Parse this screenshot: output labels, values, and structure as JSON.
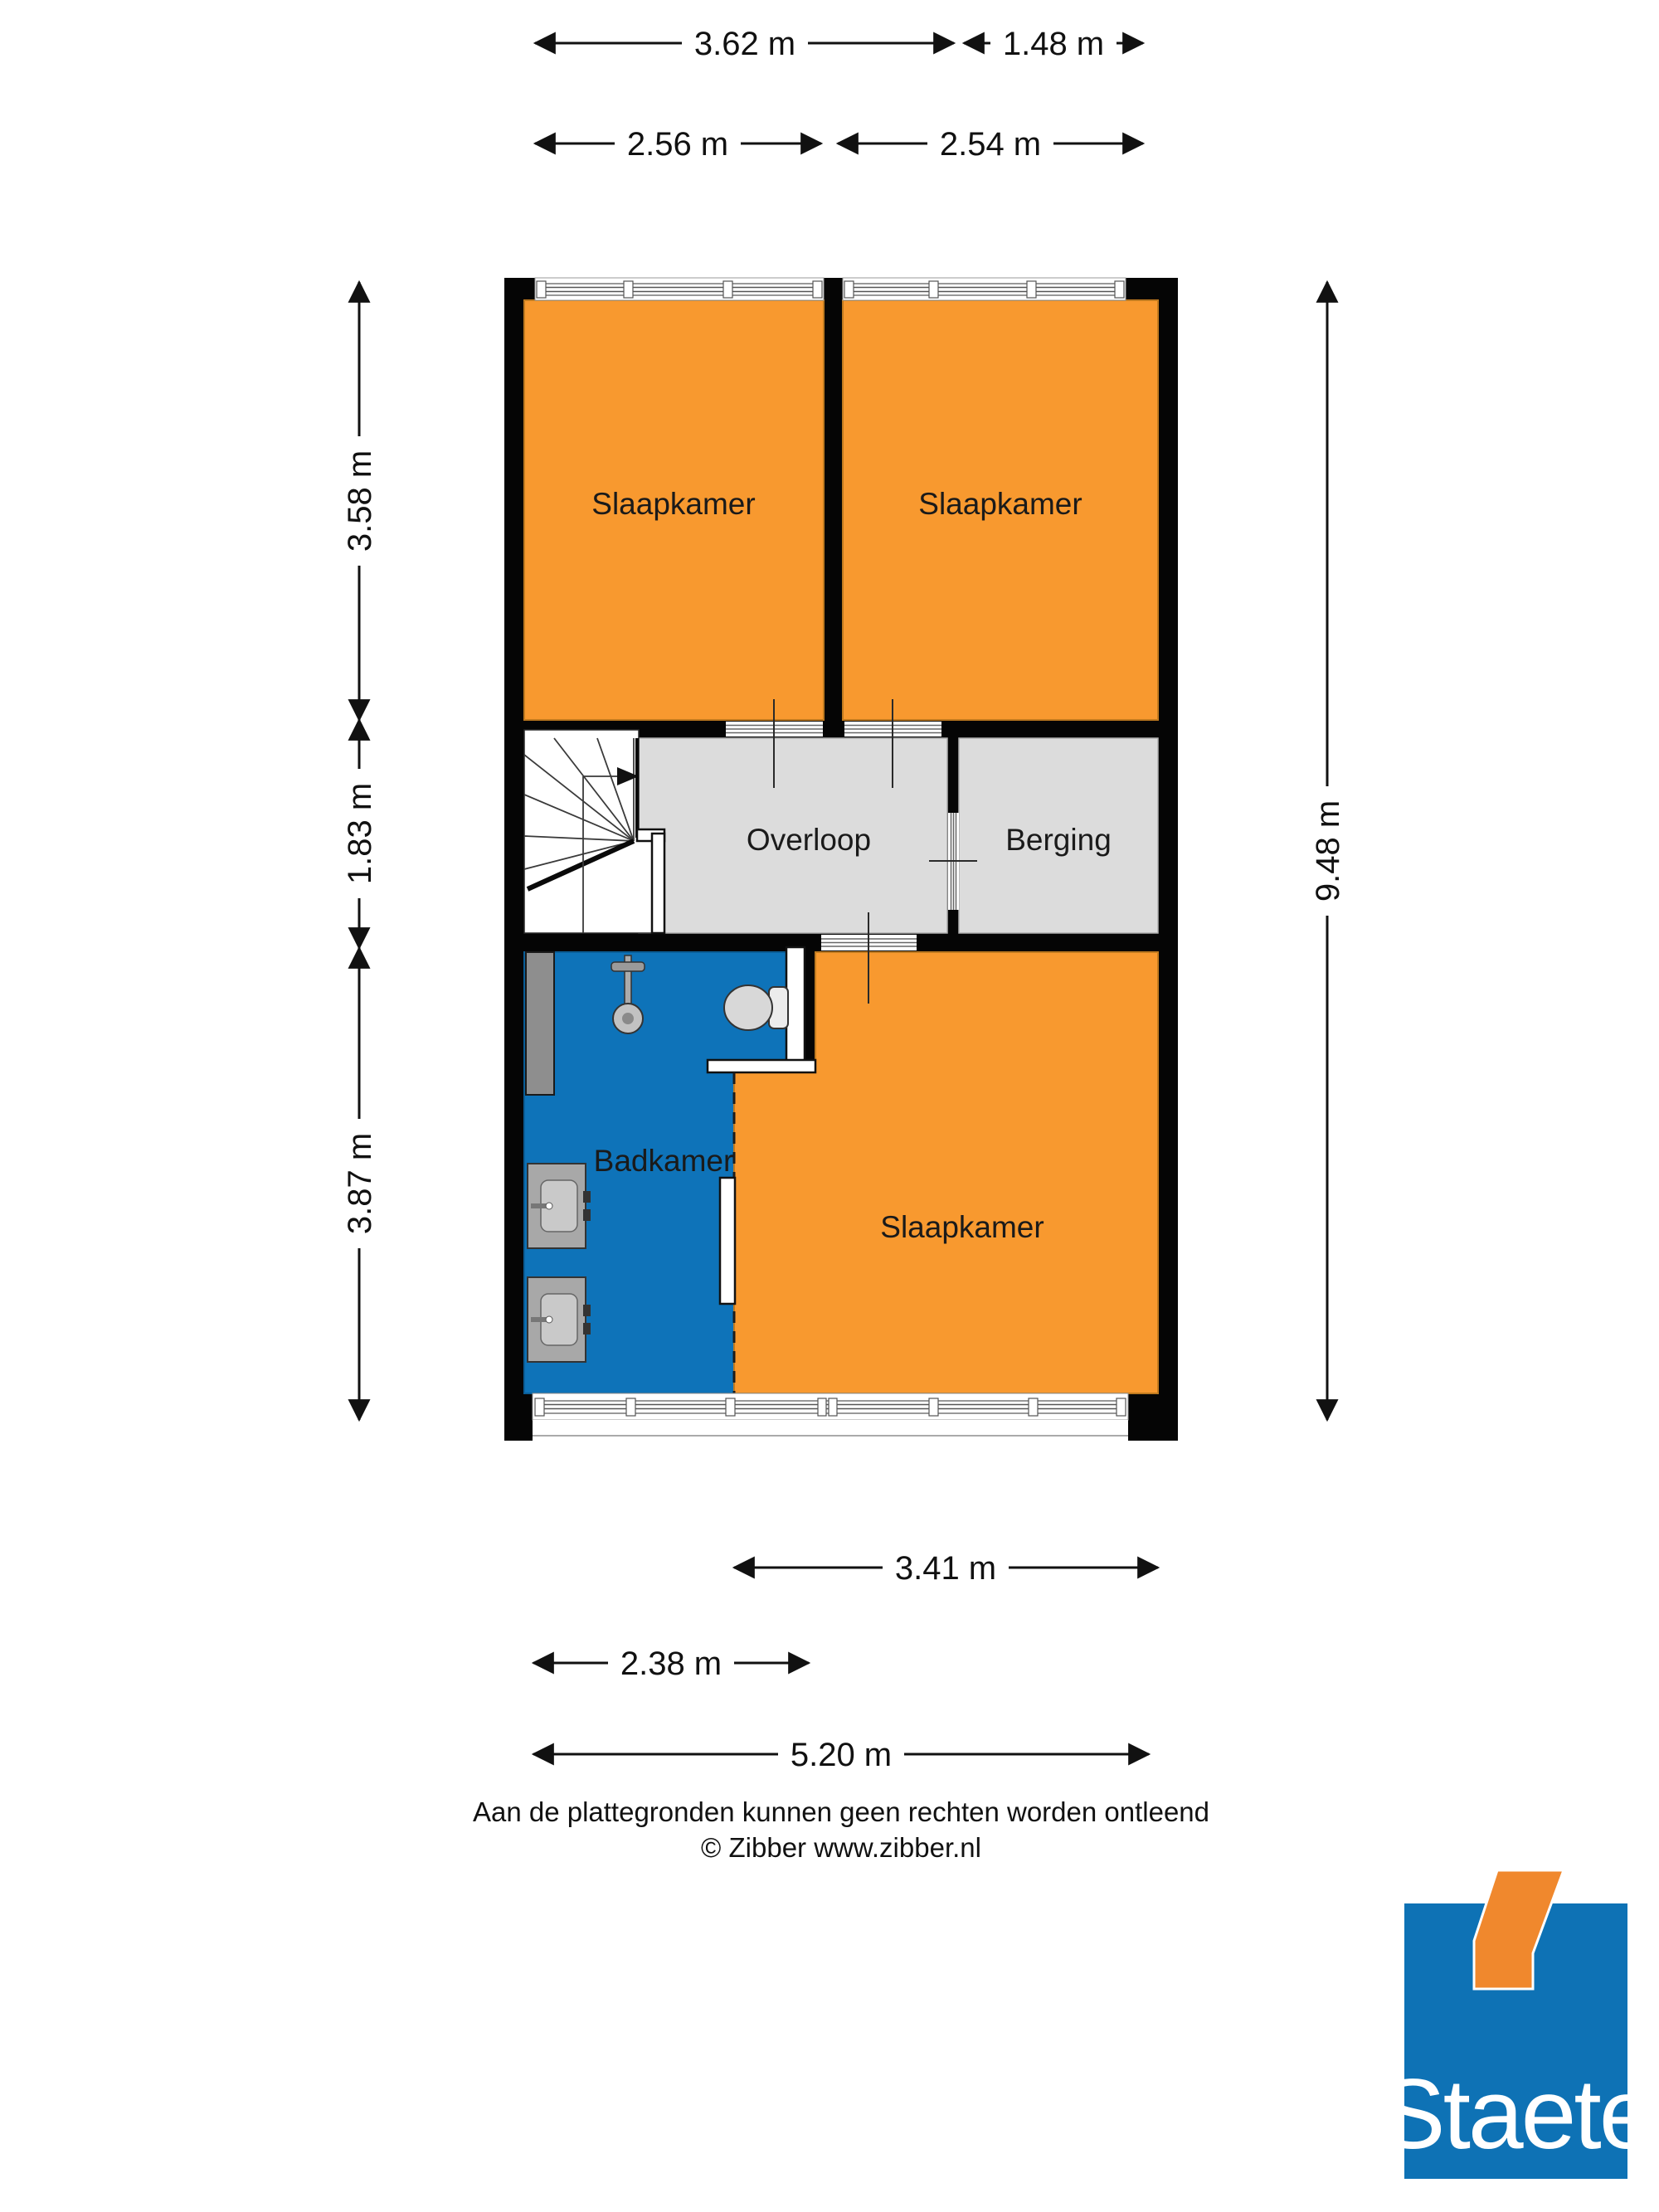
{
  "rooms": [
    {
      "id": "slaapkamer-1",
      "label": "Slaapkamer"
    },
    {
      "id": "slaapkamer-2",
      "label": "Slaapkamer"
    },
    {
      "id": "overloop",
      "label": "Overloop"
    },
    {
      "id": "berging",
      "label": "Berging"
    },
    {
      "id": "badkamer",
      "label": "Badkamer"
    },
    {
      "id": "slaapkamer-3",
      "label": "Slaapkamer"
    }
  ],
  "dimensions": {
    "top_row1": [
      {
        "label": "3.62 m"
      },
      {
        "label": "1.48 m"
      }
    ],
    "top_row2": [
      {
        "label": "2.56 m"
      },
      {
        "label": "2.54 m"
      }
    ],
    "left": [
      {
        "label": "3.58 m"
      },
      {
        "label": "1.83 m"
      },
      {
        "label": "3.87 m"
      }
    ],
    "right": [
      {
        "label": "9.48 m"
      }
    ],
    "bottom": [
      {
        "label": "3.41 m"
      },
      {
        "label": "2.38 m"
      },
      {
        "label": "5.20 m"
      }
    ]
  },
  "footer": {
    "disclaimer": "Aan de plattegronden kunnen geen rechten worden ontleend",
    "credit": "© Zibber www.zibber.nl"
  },
  "logo": {
    "text": "Staete"
  },
  "colors": {
    "room_orange": "#F8992F",
    "room_blue": "#0E73B9",
    "room_gray": "#DCDCDC",
    "wall_black": "#050505",
    "logo_blue": "#0E72B5",
    "logo_orange": "#F0882D"
  }
}
